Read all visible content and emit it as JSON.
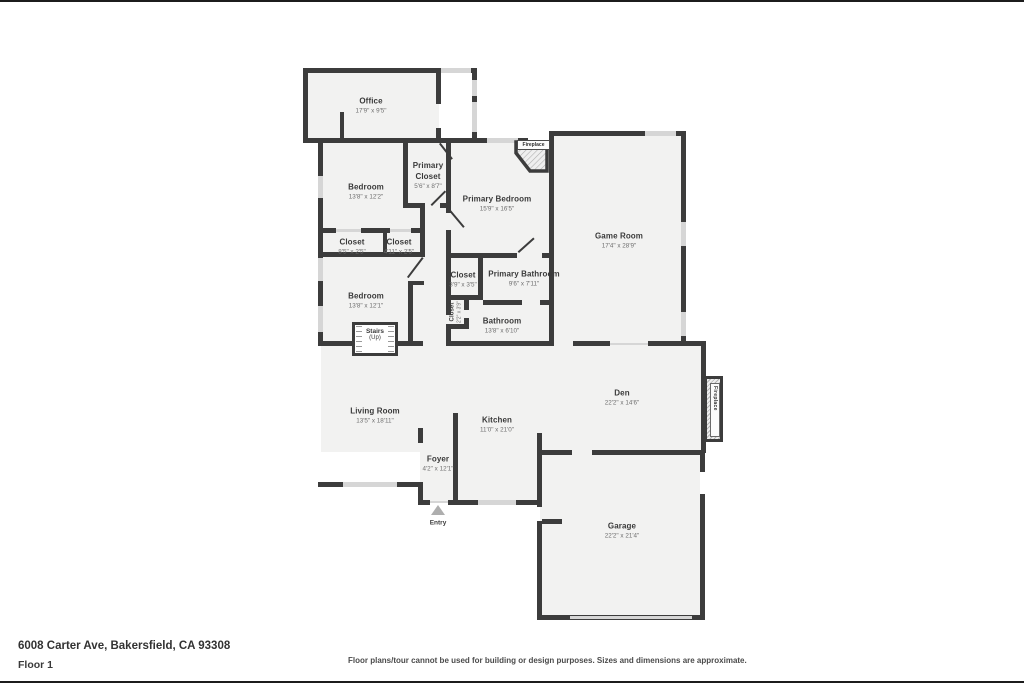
{
  "colors": {
    "wall": "#3c3c3c",
    "room_fill": "#f2f2f1",
    "window": "#d6d6d6",
    "label_text": "#3a3a3a",
    "dims_text": "#6e6e6e"
  },
  "rooms": {
    "office": {
      "name": "Office",
      "dims": "17'9\" x 9'5\""
    },
    "bedroom1": {
      "name": "Bedroom",
      "dims": "13'8\" x 12'2\""
    },
    "primary_closet": {
      "name": "Primary Closet",
      "dims": "5'6\" x 8'7\""
    },
    "primary_bedroom": {
      "name": "Primary Bedroom",
      "dims": "15'9\" x 16'5\""
    },
    "game_room": {
      "name": "Game Room",
      "dims": "17'4\" x 28'9\""
    },
    "closet_a": {
      "name": "Closet",
      "dims": "8'5\" x 2'5\""
    },
    "closet_b": {
      "name": "Closet",
      "dims": "4'11\" x 2'5\""
    },
    "bedroom2": {
      "name": "Bedroom",
      "dims": "13'8\" x 12'1\""
    },
    "closet_c": {
      "name": "Closet",
      "dims": "3'9\" x 3'5\""
    },
    "primary_bathroom": {
      "name": "Primary Bathroom",
      "dims": "9'6\" x 7'11\""
    },
    "closet_d": {
      "name": "Closet",
      "dims": "2'2\" x 3'9\""
    },
    "bathroom": {
      "name": "Bathroom",
      "dims": "13'8\" x 6'10\""
    },
    "living_room": {
      "name": "Living Room",
      "dims": "13'5\" x 18'11\""
    },
    "kitchen": {
      "name": "Kitchen",
      "dims": "11'0\" x 21'0\""
    },
    "den": {
      "name": "Den",
      "dims": "22'2\" x 14'6\""
    },
    "foyer": {
      "name": "Foyer",
      "dims": "4'2\" x 12'1\""
    },
    "garage": {
      "name": "Garage",
      "dims": "22'2\" x 21'4\""
    }
  },
  "markers": {
    "stairs_name": "Stairs",
    "stairs_sub": "(Up)",
    "entry": "Entry",
    "fireplace_game_room": "Fireplace",
    "fireplace_den": "Fireplace"
  },
  "footer": {
    "address": "6008 Carter Ave, Bakersfield, CA 93308",
    "floor_label": "Floor 1",
    "disclaimer": "Floor plans/tour cannot be used for building or design purposes. Sizes and dimensions are approximate."
  }
}
